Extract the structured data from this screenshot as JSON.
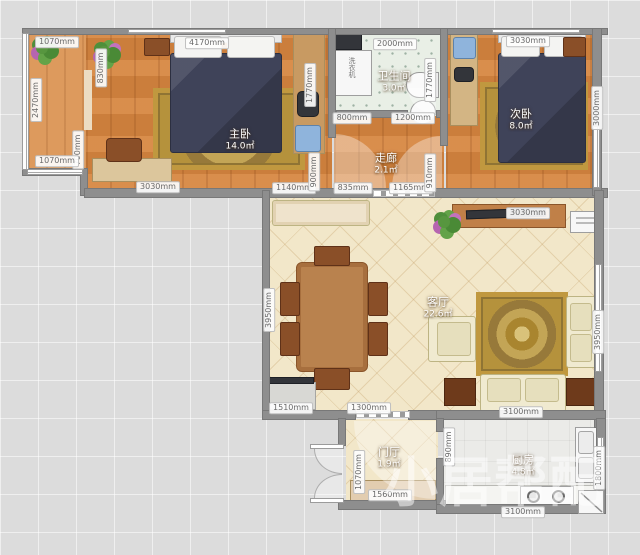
{
  "plan": {
    "rooms": {
      "master_bedroom": {
        "name": "主卧",
        "area": "14.0㎡"
      },
      "bathroom": {
        "name": "卫生间",
        "area": "3.0㎡"
      },
      "second_bedroom": {
        "name": "次卧",
        "area": "8.0㎡"
      },
      "corridor": {
        "name": "走廊",
        "area": "2.1㎡"
      },
      "living_room": {
        "name": "客厅",
        "area": "22.6㎡"
      },
      "entry_hall": {
        "name": "门厅",
        "area": "1.9㎡"
      },
      "kitchen": {
        "name": "厨房",
        "area": "4.8㎡"
      }
    },
    "labels": {
      "washing_machine": "洗衣机"
    },
    "watermark": "小居帮配",
    "colors": {
      "wall": "#8e8e8e",
      "wood_floor": "#d6853f",
      "tile_floor": "#e9efe6",
      "living_floor": "#f2e7c9",
      "bed": "#3f4359",
      "rug": "#c0983f"
    },
    "dimensions": [
      {
        "text": "1070mm",
        "x": 57,
        "y": 42,
        "v": false
      },
      {
        "text": "4170mm",
        "x": 207,
        "y": 43,
        "v": false
      },
      {
        "text": "2000mm",
        "x": 395,
        "y": 44,
        "v": false
      },
      {
        "text": "3030mm",
        "x": 528,
        "y": 41,
        "v": false
      },
      {
        "text": "830mm",
        "x": 101,
        "y": 68,
        "v": true
      },
      {
        "text": "2470mm",
        "x": 36,
        "y": 100,
        "v": true
      },
      {
        "text": "1770mm",
        "x": 310,
        "y": 85,
        "v": true
      },
      {
        "text": "1770mm",
        "x": 430,
        "y": 80,
        "v": true
      },
      {
        "text": "3000mm",
        "x": 597,
        "y": 108,
        "v": true
      },
      {
        "text": "800mm",
        "x": 352,
        "y": 118,
        "v": false
      },
      {
        "text": "1200mm",
        "x": 413,
        "y": 118,
        "v": false
      },
      {
        "text": "700mm",
        "x": 78,
        "y": 150,
        "v": true
      },
      {
        "text": "1070mm",
        "x": 57,
        "y": 161,
        "v": false
      },
      {
        "text": "3030mm",
        "x": 158,
        "y": 187,
        "v": false
      },
      {
        "text": "1140mm",
        "x": 294,
        "y": 188,
        "v": false
      },
      {
        "text": "900mm",
        "x": 314,
        "y": 172,
        "v": true
      },
      {
        "text": "835mm",
        "x": 353,
        "y": 188,
        "v": false
      },
      {
        "text": "1165mm",
        "x": 411,
        "y": 188,
        "v": false
      },
      {
        "text": "910mm",
        "x": 430,
        "y": 173,
        "v": true
      },
      {
        "text": "3030mm",
        "x": 528,
        "y": 213,
        "v": false
      },
      {
        "text": "3950mm",
        "x": 269,
        "y": 310,
        "v": true
      },
      {
        "text": "3950mm",
        "x": 598,
        "y": 332,
        "v": true
      },
      {
        "text": "1510mm",
        "x": 291,
        "y": 408,
        "v": false
      },
      {
        "text": "1300mm",
        "x": 369,
        "y": 408,
        "v": false
      },
      {
        "text": "3100mm",
        "x": 521,
        "y": 412,
        "v": false
      },
      {
        "text": "1070mm",
        "x": 359,
        "y": 472,
        "v": true
      },
      {
        "text": "890mm",
        "x": 449,
        "y": 447,
        "v": true
      },
      {
        "text": "1560mm",
        "x": 390,
        "y": 495,
        "v": false
      },
      {
        "text": "1800mm",
        "x": 599,
        "y": 468,
        "v": true
      },
      {
        "text": "3100mm",
        "x": 523,
        "y": 512,
        "v": false
      }
    ]
  }
}
